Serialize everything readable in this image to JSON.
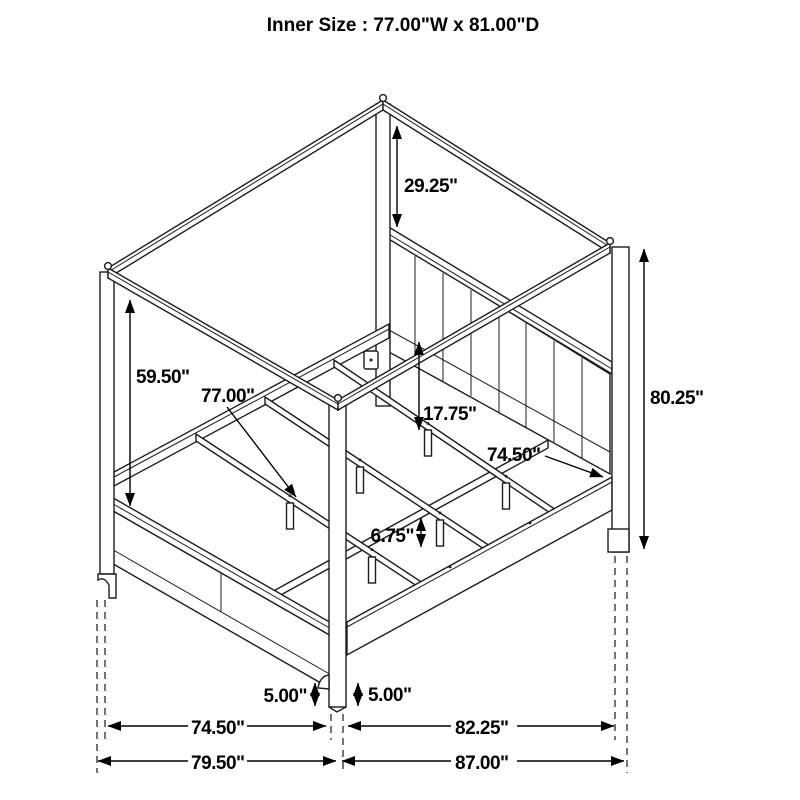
{
  "title": "Inner Size : 77.00\"W x 81.00\"D",
  "diagram_type": "canopy-bed-dimension-drawing",
  "line_color": "#1c1c1c",
  "background_color": "#ffffff",
  "dims": {
    "canopy_post": "29.25\"",
    "headboard_height": "59.50\"",
    "inner_width": "77.00\"",
    "floor_to_rail": "17.75\"",
    "rail_length": "74.50\"",
    "overall_height": "80.25\"",
    "slat_leg": "6.75\"",
    "foot_clearance_left": "5.00\"",
    "foot_clearance_right": "5.00\"",
    "footboard_span": "74.50\"",
    "side_span": "82.25\"",
    "overall_width": "79.50\"",
    "overall_depth": "87.00\""
  }
}
